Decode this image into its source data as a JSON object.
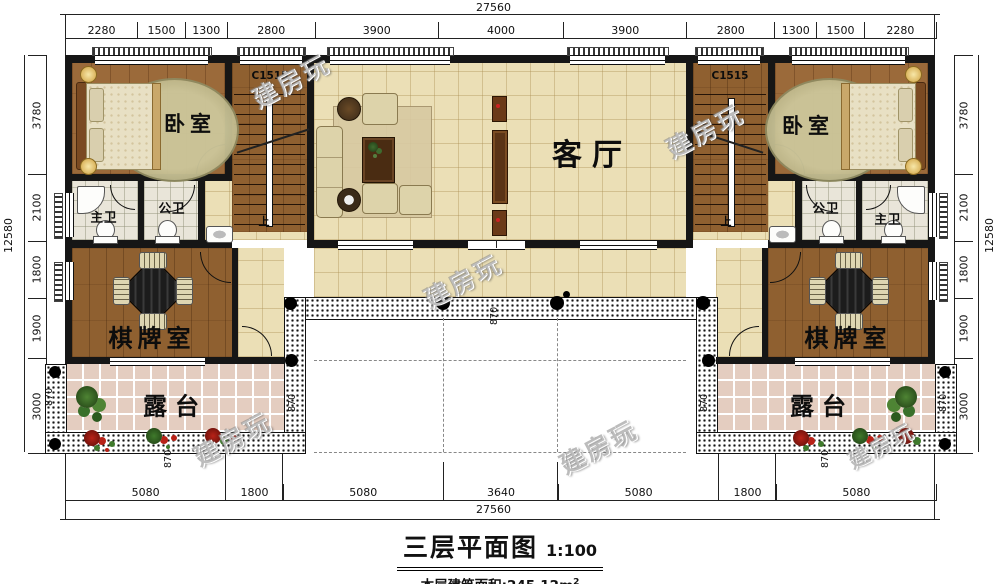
{
  "meta": {
    "title": "三层平面图",
    "scale": "1:100",
    "area_label": "本层建筑面积:",
    "area_value": "245.12m",
    "area_sup": "2"
  },
  "dims": {
    "top_total": "27560",
    "top_segments": [
      "2280",
      "1500",
      "1300",
      "2800",
      "3900",
      "4000",
      "3900",
      "2800",
      "1300",
      "1500",
      "2280"
    ],
    "bottom_total": "27560",
    "bottom_segments": [
      "5080",
      "1800",
      "5080",
      "3640",
      "5080",
      "1800",
      "5080"
    ],
    "left_total": "12580",
    "left_segments": [
      "3780",
      "2100",
      "1800",
      "1900",
      "3000"
    ],
    "right_total": "12580",
    "right_segments": [
      "3780",
      "2100",
      "1800",
      "1900",
      "3000"
    ],
    "railing": "870"
  },
  "rooms": {
    "bedroom": "卧室",
    "living": "客厅",
    "chess": "棋牌室",
    "terrace": "露台",
    "master_bath": "主卫",
    "public_bath": "公卫"
  },
  "annotations": {
    "window_code": "C1515",
    "stair_up": "上"
  },
  "watermark": "建房玩",
  "colors": {
    "wall": "#161616",
    "wood_floor": "#9b6a3a",
    "tile_floor": "#ebdfb6",
    "terrace_tile": "#e4cdc0",
    "bath_tile": "#e9e5d9"
  }
}
